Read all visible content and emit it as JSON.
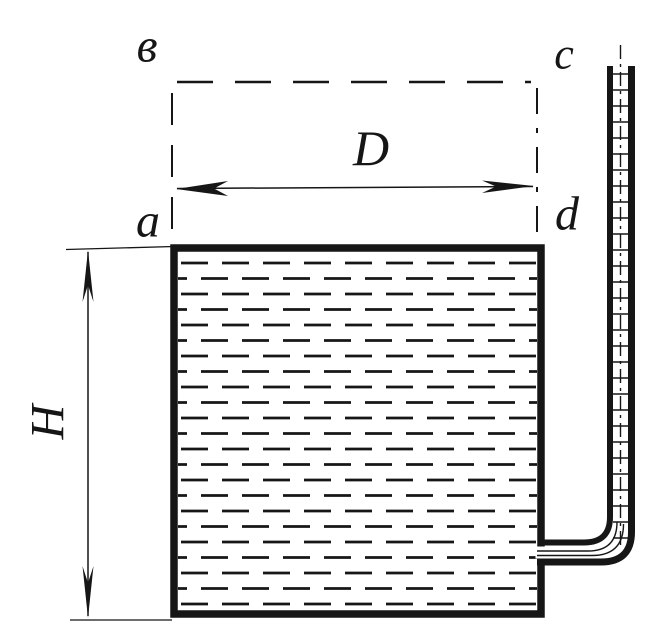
{
  "figure": {
    "labels": {
      "corner_top_left": "в",
      "corner_top_right": "c",
      "corner_bottom_left": "a",
      "corner_bottom_right": "d",
      "diameter": "D",
      "height": "H"
    },
    "colors": {
      "ink": "#161616",
      "paper": "#ffffff"
    }
  }
}
